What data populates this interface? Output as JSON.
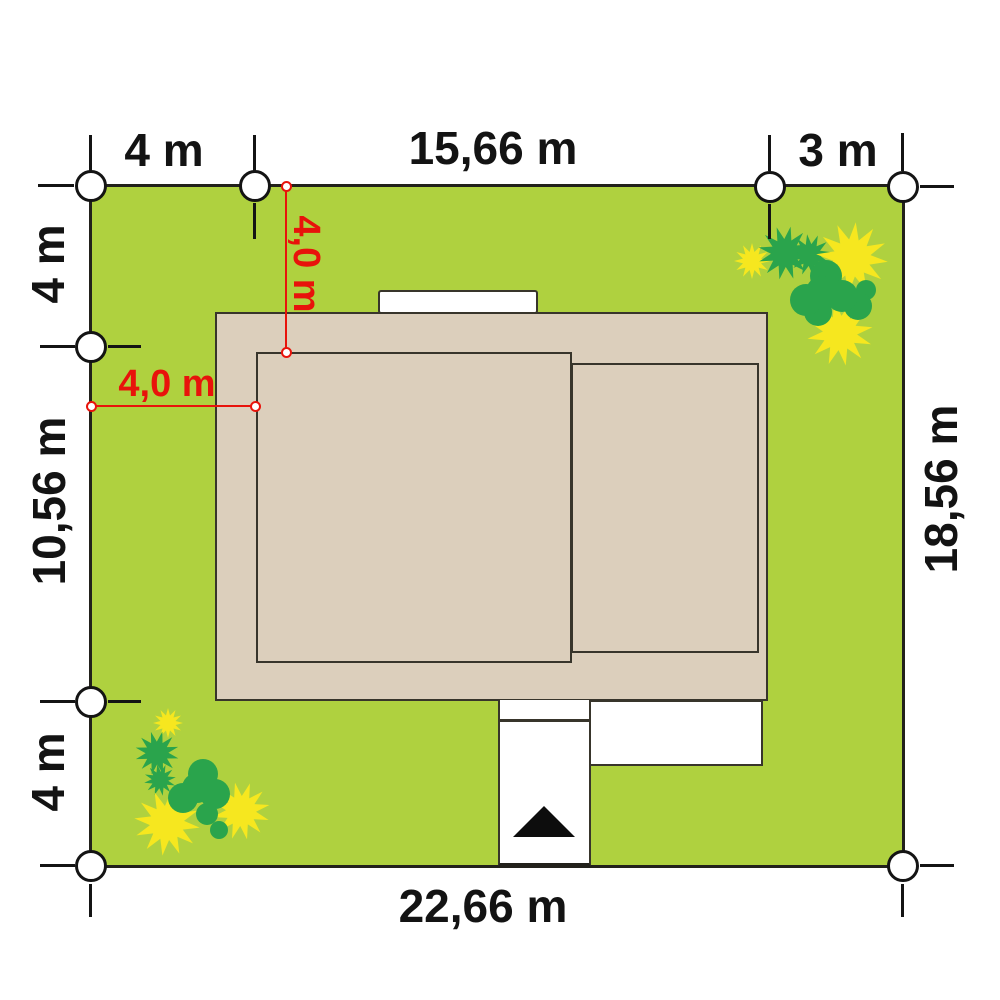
{
  "site_plan": {
    "labels": {
      "top_left_width": "4 m",
      "top_center_width": "15,66 m",
      "top_right_width": "3 m",
      "left_top_height": "4 m",
      "left_middle_height": "10,56 m",
      "left_bottom_height": "4 m",
      "right_height": "18,56 m",
      "bottom_width": "22,66 m",
      "setback_vertical": "4,0 m",
      "setback_horizontal": "4,0 m"
    },
    "colors": {
      "grass": "#afd13f",
      "roof": "#dccfbc",
      "outline": "#38352b",
      "dimension_red": "#e8130b",
      "flower_yellow": "#f6e71f",
      "bush_green": "#2aa44c",
      "marker_fill": "#ffffff",
      "text": "#131313"
    }
  }
}
